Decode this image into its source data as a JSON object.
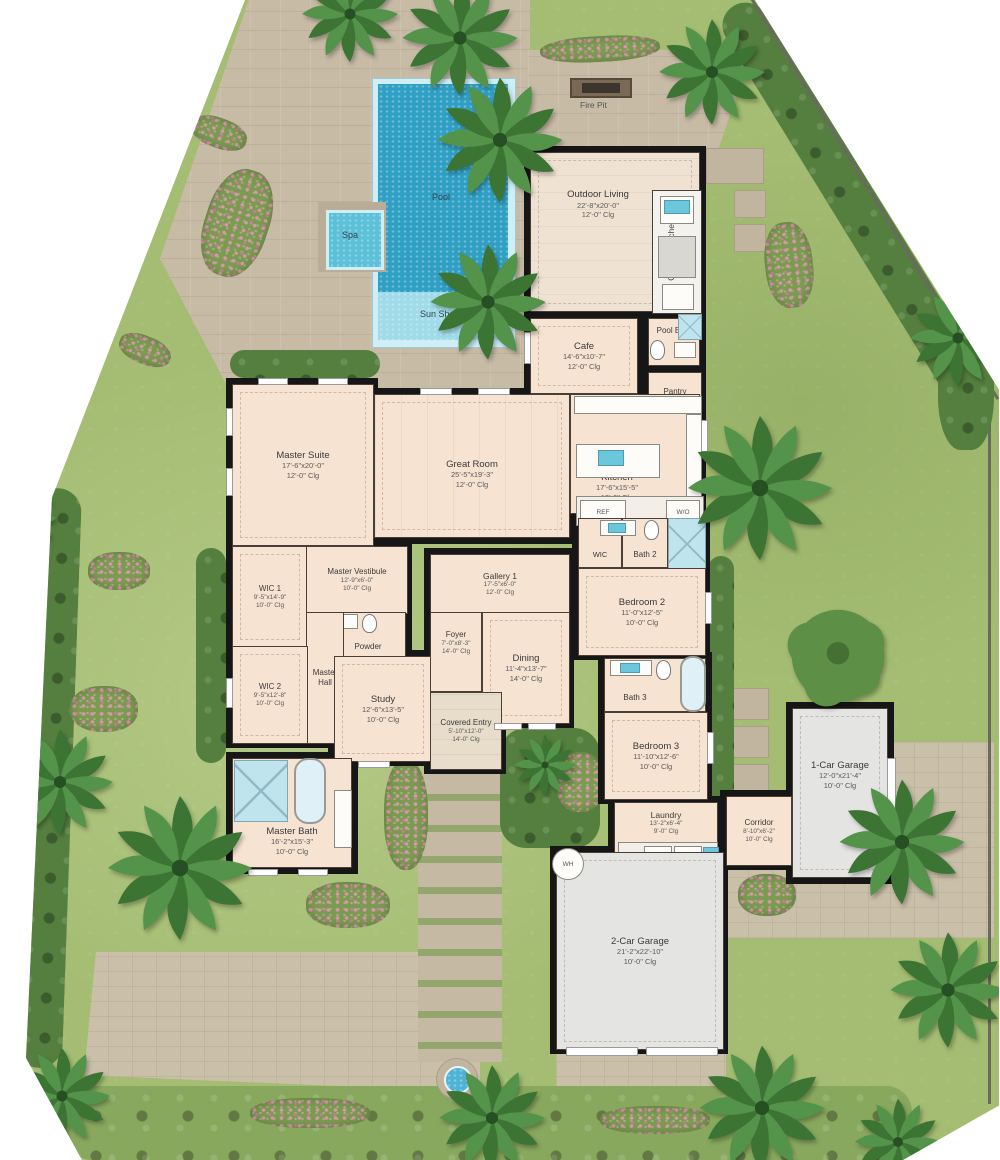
{
  "outdoor": {
    "pool": "Pool",
    "spa": "Spa",
    "sun_shelf": "Sun Shelf",
    "fire_pit": "Fire Pit"
  },
  "appliances": {
    "ref": "REF",
    "wall_oven": "W/O",
    "dryer": "D",
    "washer": "W",
    "water_heater": "WH"
  },
  "rooms": {
    "outdoor_living": {
      "name": "Outdoor Living",
      "dims": "22'-8\"x20'-0\"",
      "clg": "12'-0\" Clg"
    },
    "outdoor_kitchen": {
      "name": "Outdoor Kitchen"
    },
    "pool_bath": {
      "name": "Pool Bath"
    },
    "cafe": {
      "name": "Cafe",
      "dims": "14'-6\"x10'-7\"",
      "clg": "12'-0\" Clg"
    },
    "pantry": {
      "name": "Pantry",
      "dims": "6'-11\"x5'-5\"",
      "clg": "9'-0\" Clg"
    },
    "great_room": {
      "name": "Great Room",
      "dims": "25'-5\"x19'-3\"",
      "clg": "12'-0\" Clg"
    },
    "kitchen": {
      "name": "Kitchen",
      "dims": "17'-6\"x15'-5\"",
      "clg": "12'-0\" Clg"
    },
    "master_suite": {
      "name": "Master Suite",
      "dims": "17'-6\"x20'-0\"",
      "clg": "12'-0\" Clg"
    },
    "wic1": {
      "name": "WIC 1",
      "dims": "9'-5\"x14'-9\"",
      "clg": "10'-0\" Clg"
    },
    "master_vestibule": {
      "name": "Master Vestibule",
      "dims": "12'-9\"x6'-0\"",
      "clg": "10'-0\" Clg"
    },
    "powder": {
      "name": "Powder"
    },
    "master_hall": {
      "name": "Master Hall"
    },
    "wic2": {
      "name": "WIC 2",
      "dims": "9'-5\"x12'-8\"",
      "clg": "10'-0\" Clg"
    },
    "study": {
      "name": "Study",
      "dims": "12'-6\"x13'-5\"",
      "clg": "10'-0\" Clg"
    },
    "gallery1": {
      "name": "Gallery 1",
      "dims": "17'-5\"x6'-0\"",
      "clg": "12'-0\" Clg"
    },
    "foyer": {
      "name": "Foyer",
      "dims": "7'-0\"x8'-3\"",
      "clg": "14'-0\" Clg"
    },
    "dining": {
      "name": "Dining",
      "dims": "11'-4\"x13'-7\"",
      "clg": "14'-0\" Clg"
    },
    "covered_entry": {
      "name": "Covered Entry",
      "dims": "5'-10\"x12'-0\"",
      "clg": "14'-0\" Clg"
    },
    "wic_small": {
      "name": "WIC"
    },
    "bath2": {
      "name": "Bath 2"
    },
    "bedroom2": {
      "name": "Bedroom 2",
      "dims": "11'-0\"x12'-5\"",
      "clg": "10'-0\" Clg"
    },
    "bath3": {
      "name": "Bath 3"
    },
    "bedroom3": {
      "name": "Bedroom 3",
      "dims": "11'-10\"x12'-6\"",
      "clg": "10'-0\" Clg"
    },
    "master_bath": {
      "name": "Master Bath",
      "dims": "16'-2\"x15'-3\"",
      "clg": "10'-0\" Clg"
    },
    "laundry": {
      "name": "Laundry",
      "dims": "13'-2\"x6'-4\"",
      "clg": "9'-0\" Clg"
    },
    "corridor": {
      "name": "Corridor",
      "dims": "8'-10\"x6'-2\"",
      "clg": "10'-0\" Clg"
    },
    "garage1": {
      "name": "1-Car Garage",
      "dims": "12'-0\"x21'-4\"",
      "clg": "10'-0\" Clg"
    },
    "garage2": {
      "name": "2-Car Garage",
      "dims": "21'-2\"x22'-10\"",
      "clg": "10'-0\" Clg"
    }
  },
  "colors": {
    "pool_water": "#2f9fc4",
    "sun_shelf": "#9fdbe8",
    "spa": "#5cc0d8",
    "lawn": "#a4bd72",
    "paver": "#c7bba6",
    "floor": "#f6e3d2",
    "wall": "#161616",
    "garage_floor": "#e4e4e2",
    "shower_tile": "#bfe4ee"
  }
}
